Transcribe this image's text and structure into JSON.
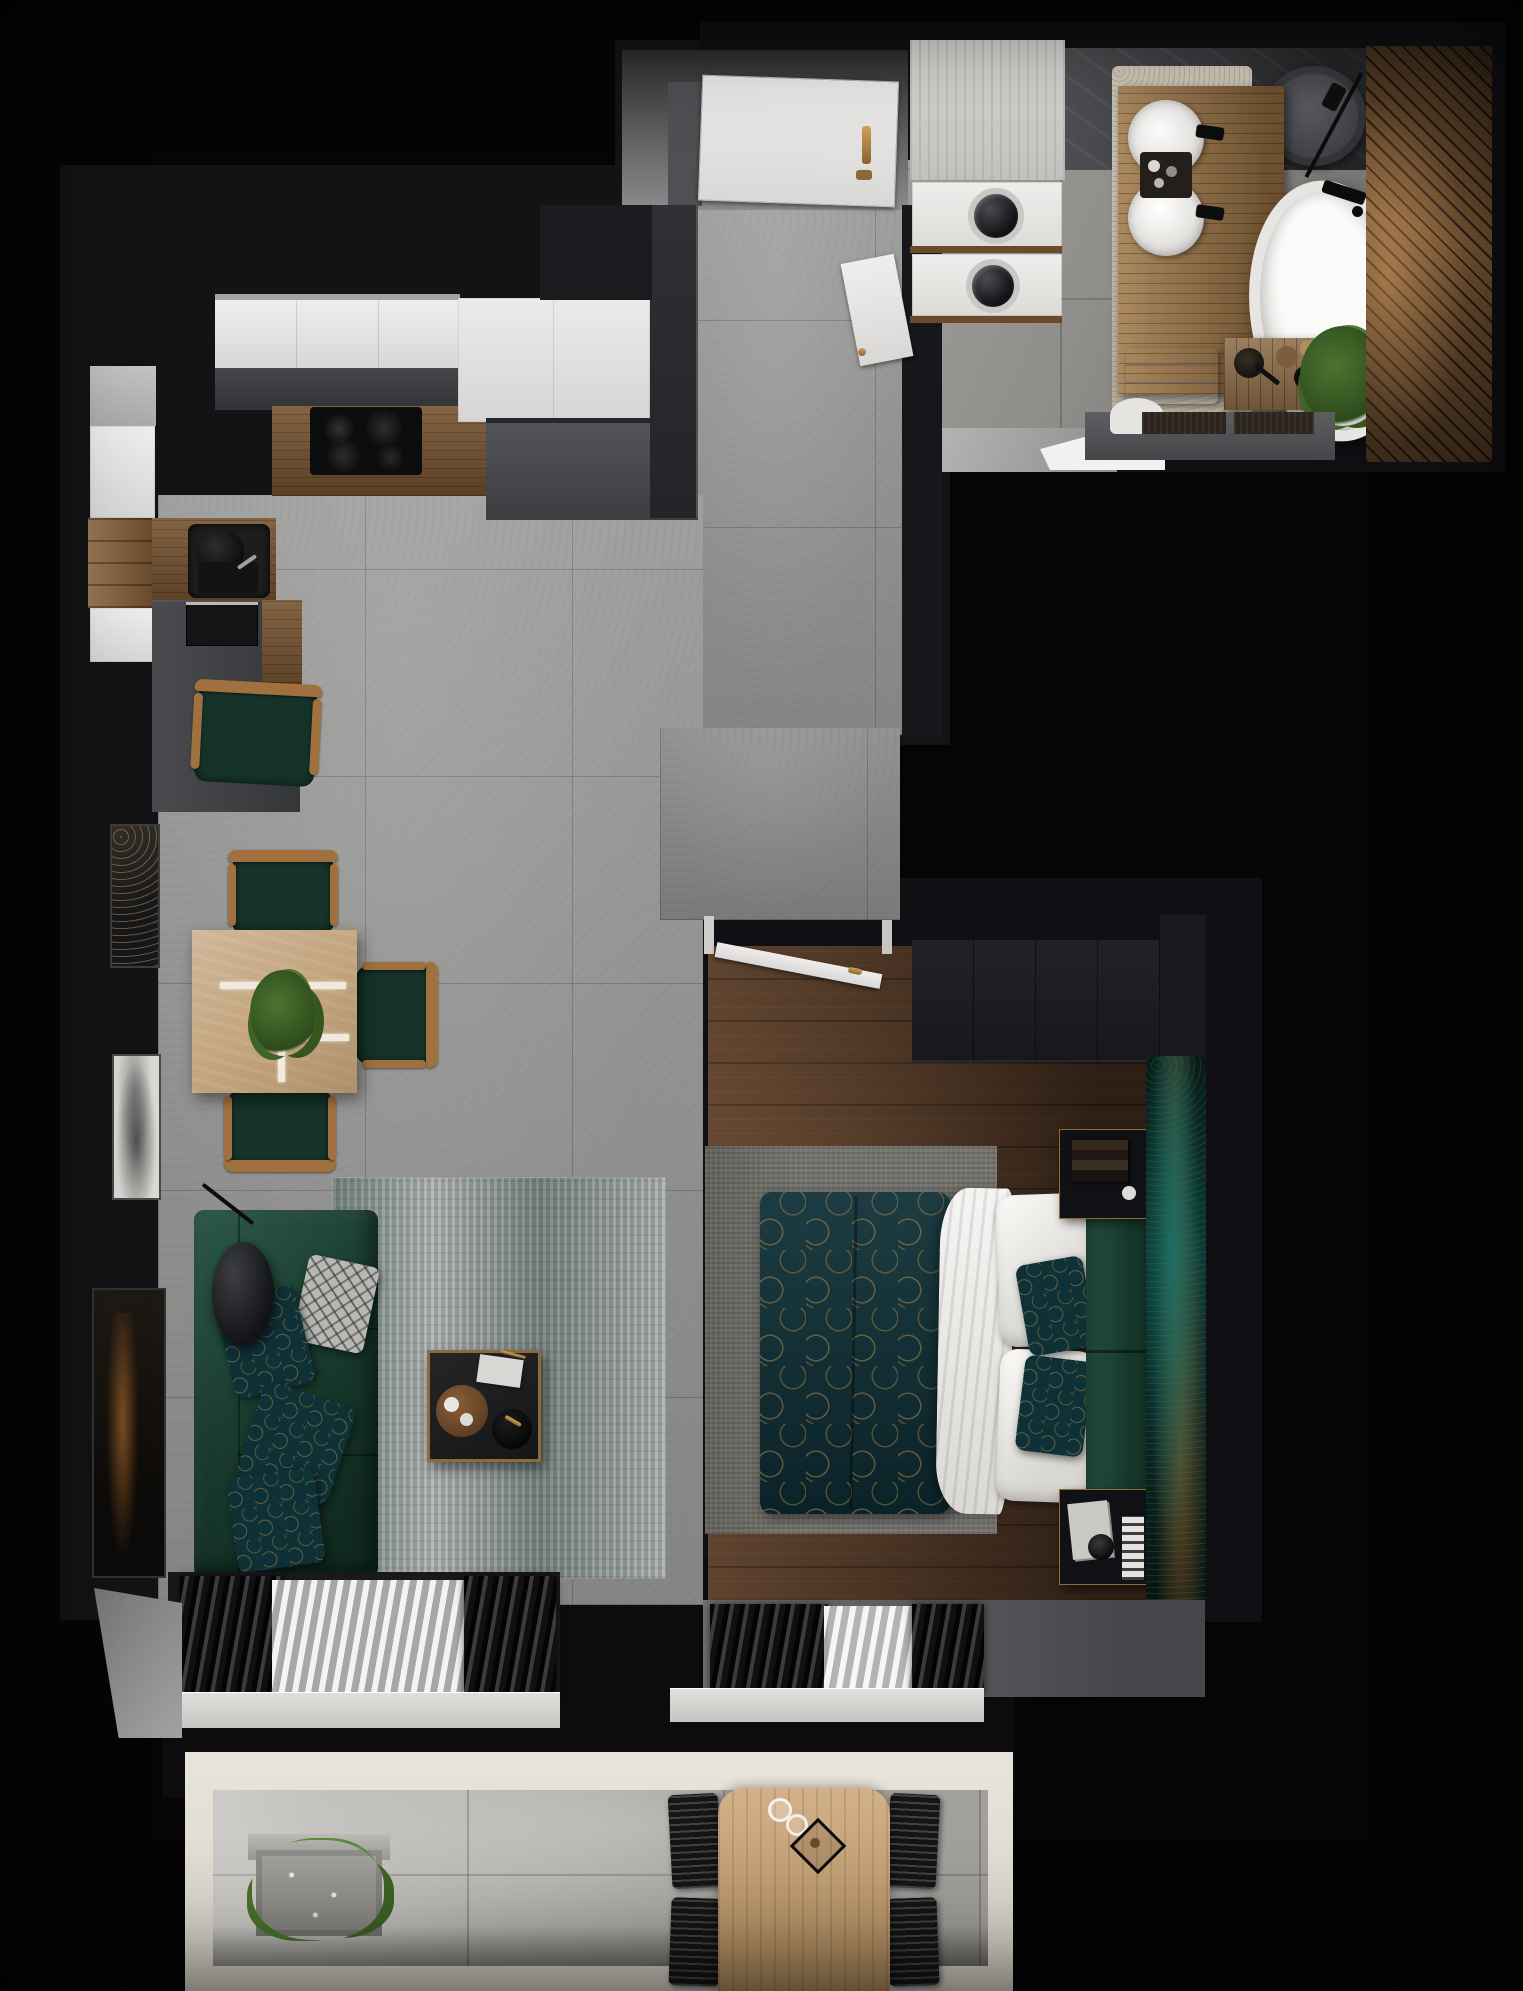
{
  "meta": {
    "title": "Apartment floor plan - photorealistic 3D top-down render",
    "canvas_width_px": 1523,
    "canvas_height_px": 1991,
    "visible_text": "none"
  },
  "colors": {
    "wall-dark": "#131316",
    "concrete": "#9b9b99",
    "wood-floor": "#4d3423",
    "wood-counter": "#75522f",
    "bath-floor": "#8f8d8a",
    "marble": "#b5b3ae",
    "beige-rug": "#cdc3b1",
    "rug-gray": "#9aa09e",
    "frame-white": "#e9e4da",
    "table-travertine": "#c2a37c",
    "chair-wood": "#a0713f",
    "chair-seat": "#153329",
    "outdoor-table-wood": "#c89e6b",
    "sofa-green": "#1f4a39",
    "duvet-teal": "#0e3037",
    "accent-teal": "#0b3a38",
    "gold": "#b48a4c"
  },
  "rooms": {
    "entry": {
      "label": "Entry hall",
      "items": [
        "entry door",
        "gold door handle",
        "concrete corridor",
        "side door to bathroom"
      ]
    },
    "kitchen": {
      "label": "Kitchen",
      "items": [
        "white upper cabinets",
        "gray base cabinets",
        "wood countertop",
        "induction cooktop",
        "sink",
        "built-in oven",
        "tall white cabinets"
      ]
    },
    "living_dining": {
      "label": "Living / dining room",
      "items": [
        "dining table",
        "dining chairs",
        "corner sofa",
        "patterned pillows",
        "floor lamp",
        "coffee table",
        "distressed rug",
        "wall art",
        "window curtains"
      ]
    },
    "bedroom": {
      "label": "Bedroom",
      "items": [
        "double bed",
        "teal patterned duvet",
        "white pillows",
        "green headboard",
        "nightstands",
        "wardrobe",
        "teal accent wall",
        "open door",
        "window curtains"
      ]
    },
    "bathroom": {
      "label": "Bathroom",
      "items": [
        "washer dryer column",
        "toilet",
        "double vanity with round sinks",
        "towels",
        "beige rug",
        "freestanding bathtub",
        "bath caddy",
        "plant",
        "wood slat wall",
        "shower set"
      ]
    },
    "balcony": {
      "label": "Balcony",
      "items": [
        "marble tile floor",
        "planter with grasses",
        "outdoor wood table",
        "black slatted chairs",
        "lantern and glasses"
      ]
    }
  }
}
